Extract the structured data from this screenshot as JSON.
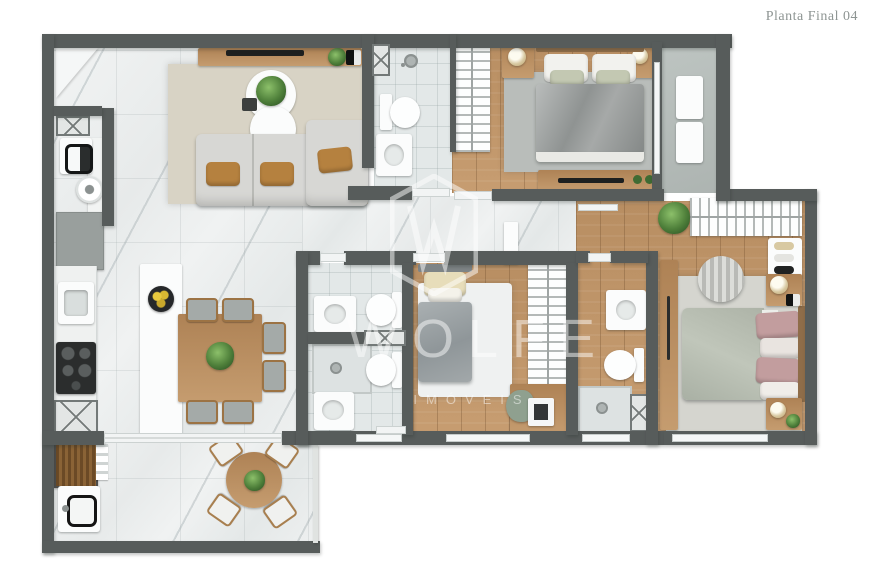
{
  "title": "Planta Final 04",
  "watermark": {
    "name": "WOLFE",
    "subtitle": "IMÓVEIS"
  },
  "colors": {
    "wall": "#575c5b",
    "marble": "#e9eceb",
    "tile": "#e3e8e8",
    "wood": "#c1966a",
    "balcony-floor": "#b8bfbc",
    "rug-beige": "#d8d3c5",
    "rug-gray": "#b9bdba",
    "rug-white": "#eff1f1",
    "suite-rug": "#d5d5cf",
    "sofa": "#d7d7d4",
    "pillow-tan": "#b5813f",
    "bed-silver": "#9a9e9d",
    "bed-sage": "#b7bdb0",
    "pillow-mauve": "#c29d9e",
    "plant-green": "#4e7f3a",
    "fixture-white": "#fbfcfc",
    "title-color": "#8e9593",
    "watermark-color": "rgba(255,255,255,0.48)"
  }
}
